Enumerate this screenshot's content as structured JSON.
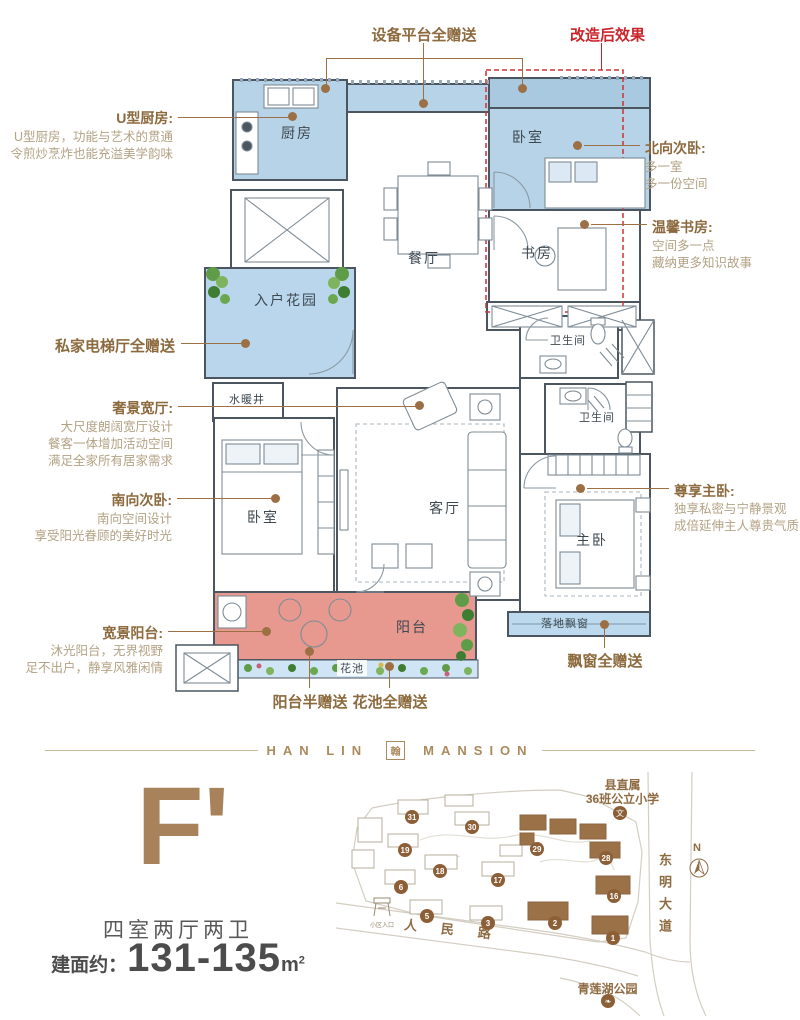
{
  "floorplan": {
    "rooms": {
      "kitchen": "厨房",
      "bedroom_north": "卧室",
      "study": "书房",
      "dining": "餐厅",
      "living": "客厅",
      "bath1": "卫生间",
      "bath2": "卫生间",
      "bedroom_south": "卧室",
      "master": "主卧",
      "balcony": "阳台",
      "flower_bed": "花池",
      "entry_garden": "入户花园",
      "utility_shaft": "水暖井",
      "bay_window": "落地飘窗"
    },
    "annotations": {
      "kitchen": {
        "title": "U型厨房:",
        "desc1": "U型厨房，功能与艺术的贯通",
        "desc2": "令煎炒烹炸也能充溢美学韵味"
      },
      "elevator_gift": {
        "title": "私家电梯厅全赠送"
      },
      "living_hall": {
        "title": "奢景宽厅:",
        "desc1": "大尺度朗阔宽厅设计",
        "desc2": "餐客一体增加活动空间",
        "desc3": "满足全家所有居家需求"
      },
      "south_bedroom": {
        "title": "南向次卧:",
        "desc1": "南向空间设计",
        "desc2": "享受阳光眷顾的美好时光"
      },
      "balcony_view": {
        "title": "宽景阳台:",
        "desc1": "沐光阳台，无界视野",
        "desc2": "足不出户，静享风雅闲情"
      },
      "balcony_gift": {
        "title": "阳台半赠送"
      },
      "flower_gift": {
        "title": "花池全赠送"
      },
      "platform_gift": {
        "title": "设备平台全赠送"
      },
      "renovation": {
        "title": "改造后效果"
      },
      "north_bedroom": {
        "title": "北向次卧:",
        "desc1": "多一室",
        "desc2": "多一份空间"
      },
      "study_note": {
        "title": "温馨书房:",
        "desc1": "空间多一点",
        "desc2": "藏纳更多知识故事"
      },
      "master_note": {
        "title": "尊享主卧:",
        "desc1": "独享私密与宁静景观",
        "desc2": "成倍延伸主人尊贵气质"
      },
      "baywindow_gift": {
        "title": "飘窗全赠送"
      }
    }
  },
  "brand": {
    "left": "HAN LIN",
    "right": "MANSION",
    "logo_char": "翰"
  },
  "unit": {
    "code": "F'",
    "layout": "四室两厅两卫",
    "area_label": "建面约：",
    "area_value": "131-135",
    "area_unit_base": "m",
    "area_unit_sup": "2"
  },
  "sitemap": {
    "school_line1": "县直属",
    "school_line2": "36班公立小学",
    "school_icon": "文",
    "road_east": "东明大道",
    "road_south": "人民路",
    "park": "青莲湖公园",
    "compass": "N",
    "entrance": "小区入口",
    "building_numbers": [
      {
        "n": "31",
        "x": 412,
        "y": 817
      },
      {
        "n": "30",
        "x": 472,
        "y": 827
      },
      {
        "n": "19",
        "x": 405,
        "y": 850
      },
      {
        "n": "29",
        "x": 537,
        "y": 849
      },
      {
        "n": "28",
        "x": 606,
        "y": 858
      },
      {
        "n": "18",
        "x": 440,
        "y": 871
      },
      {
        "n": "17",
        "x": 498,
        "y": 880
      },
      {
        "n": "6",
        "x": 401,
        "y": 887
      },
      {
        "n": "16",
        "x": 614,
        "y": 896
      },
      {
        "n": "5",
        "x": 427,
        "y": 916
      },
      {
        "n": "3",
        "x": 488,
        "y": 923
      },
      {
        "n": "2",
        "x": 555,
        "y": 923
      },
      {
        "n": "1",
        "x": 613,
        "y": 938
      }
    ]
  },
  "colors": {
    "accent_brown": "#8c6a3e",
    "desc_tan": "#b3a284",
    "highlight_red": "#c9252b",
    "room_blue": "#b6d3e8",
    "balcony_pink": "#e7988f",
    "map_brown": "#8d5f36"
  }
}
